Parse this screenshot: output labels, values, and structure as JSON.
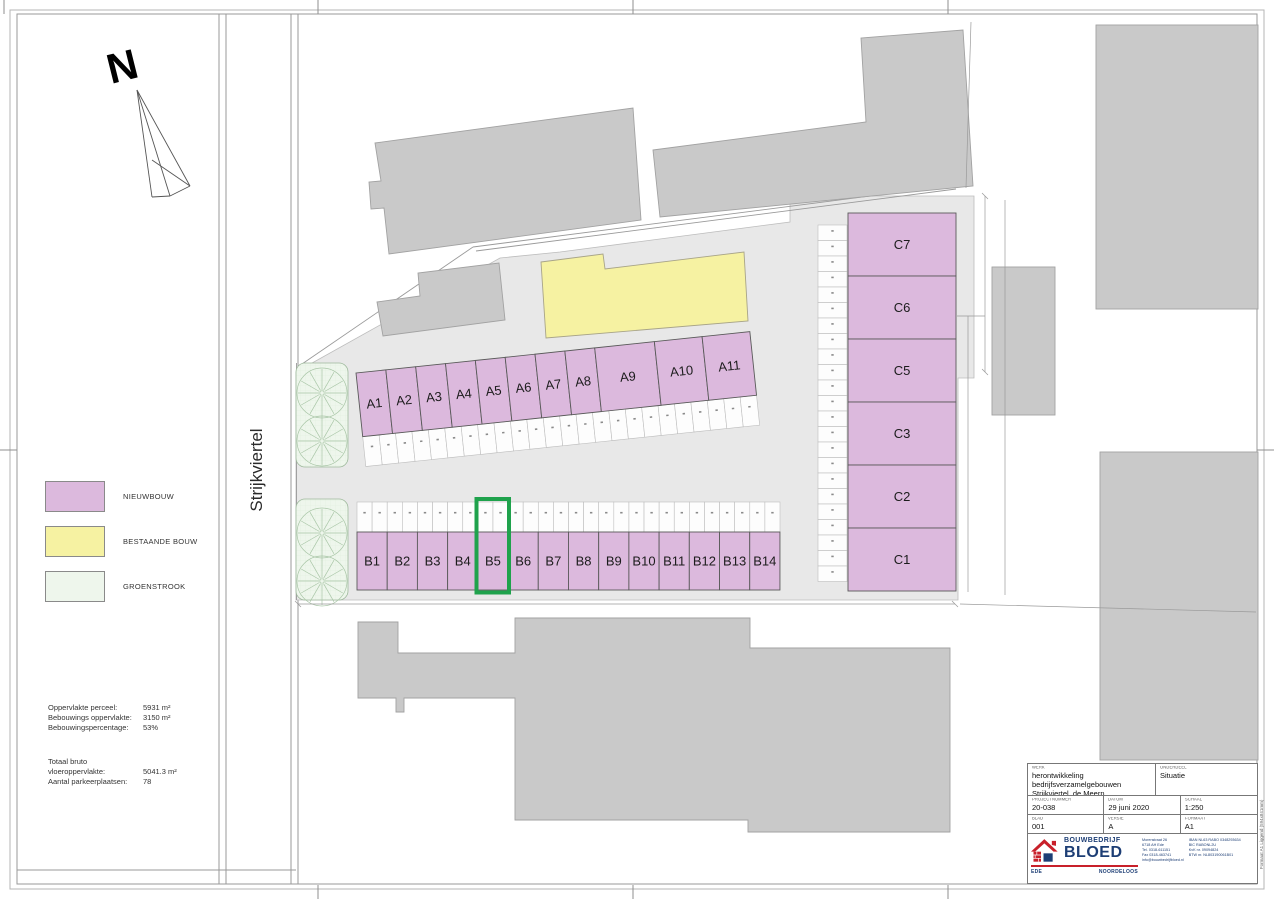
{
  "sheet": {
    "north_label": "N",
    "street_label": "Strijkviertel",
    "side_note": "Formaat A1 Liggend (594x841mm)"
  },
  "legend": {
    "items": [
      {
        "label": "NIEUWBOUW",
        "color": "#dcb9dd"
      },
      {
        "label": "BESTAANDE BOUW",
        "color": "#f6f2a2"
      },
      {
        "label": "GROENSTROOK",
        "color": "#eef6ec"
      }
    ]
  },
  "stats": {
    "block1": [
      {
        "label": "Oppervlakte perceel:",
        "value": "5931 m²"
      },
      {
        "label": "Bebouwings oppervlakte:",
        "value": "3150 m²"
      },
      {
        "label": "Bebouwingspercentage:",
        "value": "53%"
      }
    ],
    "block2": [
      {
        "label": "Totaal bruto vloeroppervlakte:",
        "value": "5041.3 m²"
      },
      {
        "label": "Aantal parkeerplaatsen:",
        "value": "78"
      }
    ]
  },
  "plan": {
    "rows": {
      "a": [
        "A1",
        "A2",
        "A3",
        "A4",
        "A5",
        "A6",
        "A7",
        "A8",
        "A9",
        "A10",
        "A11"
      ],
      "b": [
        "B1",
        "B2",
        "B3",
        "B4",
        "B5",
        "B6",
        "B7",
        "B8",
        "B9",
        "B10",
        "B11",
        "B12",
        "B13",
        "B14"
      ],
      "c": [
        "C7",
        "C6",
        "C5",
        "C3",
        "C2",
        "C1"
      ]
    },
    "highlight_unit": "B5",
    "highlight_color": "#1fa24c"
  },
  "titleblock": {
    "werk_label": "WERK",
    "project_line1": "herontwikkeling bedrijfsverzamelgebouwen",
    "project_line2": "Strijkviertel, de Meern",
    "onderdeel_label": "ONDERDEEL",
    "onderdeel_value": "Situatie",
    "fields": [
      {
        "label": "PROJECTNUMMER",
        "value": "20-038"
      },
      {
        "label": "DATUM",
        "value": "29 juni 2020"
      },
      {
        "label": "SCHAAL",
        "value": "1:250"
      },
      {
        "label": "BLAD",
        "value": "001"
      },
      {
        "label": "VERSIE",
        "value": "A"
      },
      {
        "label": "FORMAAT",
        "value": "A1"
      }
    ],
    "logo": {
      "line1": "BOUWBEDRIJF",
      "line2": "BLOED",
      "city_left": "EDE",
      "city_right": "NOORDELOOS",
      "red": "#c8202a",
      "navy": "#1d3e75"
    },
    "contact_col1": [
      "Morenstraat 26",
      "6718 AH  Ede",
      "Tel. 0318-611151",
      "Fax 0318-463741",
      "info@bouwbedrijfbloed.nl"
    ],
    "contact_col2": [
      "IBAN NL63 RABO 0348293634",
      "BIC RABONL2U",
      "KvK nr. 09094824",
      "BTW nr. NL803190061B01"
    ]
  }
}
